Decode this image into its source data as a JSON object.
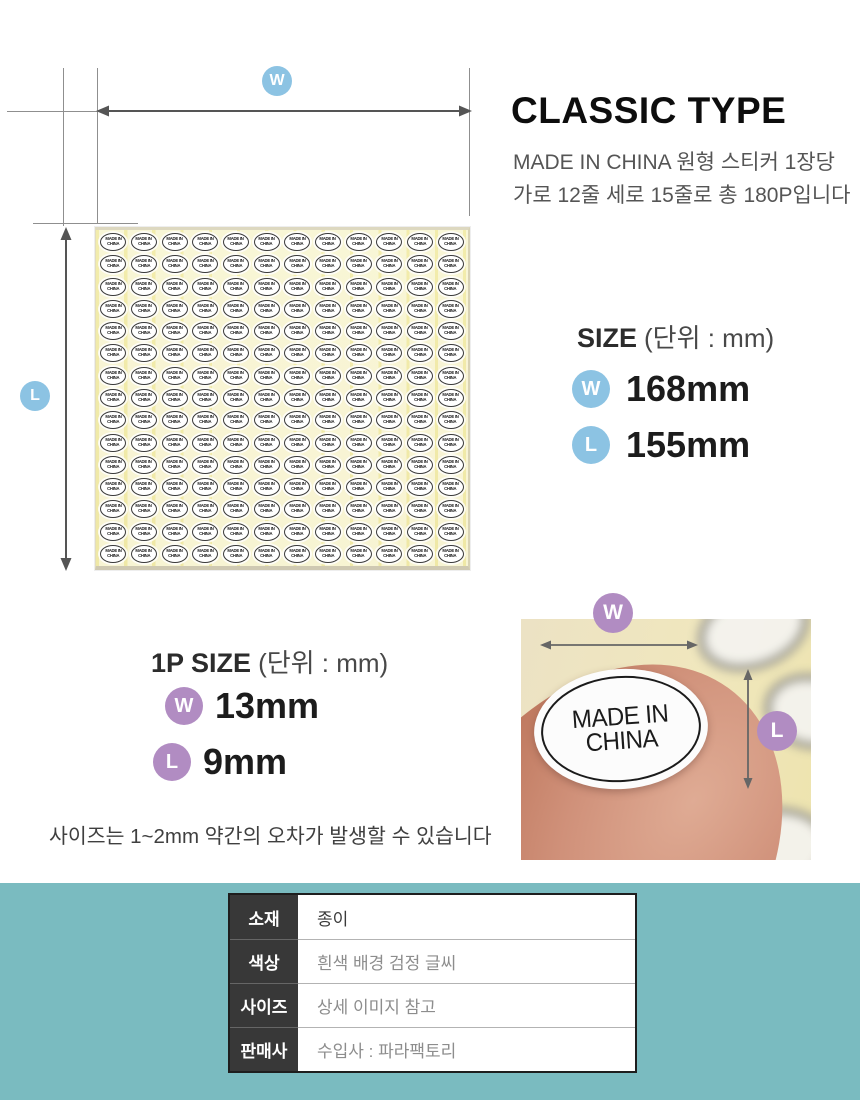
{
  "header": {
    "title": "CLASSIC TYPE",
    "description_line1": "MADE IN CHINA 원형 스티커 1장당",
    "description_line2": "가로 12줄 세로 15줄로 총 180P입니다"
  },
  "diagram": {
    "w_label": "W",
    "l_label": "L",
    "sheet": {
      "columns": 12,
      "rows": 15,
      "sticker_line1": "MADE IN",
      "sticker_line2": "CHINA"
    }
  },
  "size_section": {
    "heading": "SIZE",
    "heading_unit": "(단위 : mm)",
    "rows": [
      {
        "badge": "W",
        "value": "168mm"
      },
      {
        "badge": "L",
        "value": "155mm"
      }
    ]
  },
  "one_piece_section": {
    "heading": "1P SIZE",
    "heading_unit": "(단위 : mm)",
    "rows": [
      {
        "badge": "W",
        "value": "13mm"
      },
      {
        "badge": "L",
        "value": "9mm"
      }
    ],
    "note": "사이즈는 1~2mm 약간의 오차가 발생할 수 있습니다"
  },
  "photo": {
    "w_label": "W",
    "l_label": "L",
    "sticker_line1": "MADE IN",
    "sticker_line2": "CHINA"
  },
  "spec_table": {
    "rows": [
      {
        "label": "소재",
        "value": "종이"
      },
      {
        "label": "색상",
        "value": "흰색 배경 검정 글씨"
      },
      {
        "label": "사이즈",
        "value": "상세 이미지 참고"
      },
      {
        "label": "판매사",
        "value": "수입사 : 파라팩토리"
      }
    ]
  },
  "colors": {
    "blue_badge": "#8cc3e3",
    "purple_badge": "#b18cc2",
    "teal_background": "#7abbc0",
    "sheet_yellow": "#f1ebb0",
    "arrow_gray": "#555555",
    "table_header_bg": "#383838"
  }
}
